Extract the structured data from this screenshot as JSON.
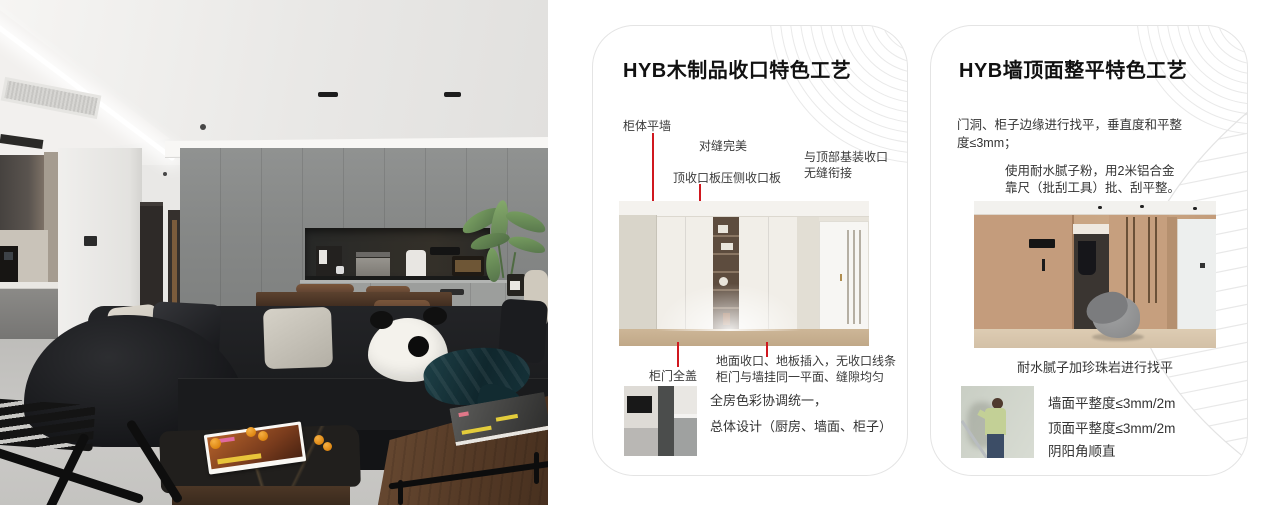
{
  "colors": {
    "accent_red": "#d0181f",
    "card_border": "#e4e4e4",
    "pattern_line": "#e9e9e9"
  },
  "cards": [
    {
      "title": "HYB木制品收口特色工艺",
      "callouts": {
        "cabinet_wall": "柜体平墙",
        "seam_perfect": "对缝完美",
        "top_panel": "顶收口板压侧收口板",
        "top_joint_line1": "与顶部基装收口",
        "top_joint_line2": "无缝衔接",
        "door_cover": "柜门全盖",
        "floor_line1": "地面收口、地板插入，无收口线条",
        "floor_line2": "柜门与墙挂同一平面、缝隙均匀"
      },
      "summary_line1": "全房色彩协调统一，",
      "summary_line2": "总体设计（厨房、墙面、柜子）"
    },
    {
      "title": "HYB墙顶面整平特色工艺",
      "para1_line1": "门洞、柜子边缘进行找平，垂直度和平整",
      "para1_line2": "度≤3mm；",
      "para2_line1": "使用耐水腻子粉，用2米铝合金",
      "para2_line2": "靠尺（批刮工具）批、刮平整。",
      "caption": "耐水腻子加珍珠岩进行找平",
      "spec1": "墙面平整度≤3mm/2m",
      "spec2": "顶面平整度≤3mm/2m",
      "spec3": "阴阳角顺直"
    }
  ]
}
